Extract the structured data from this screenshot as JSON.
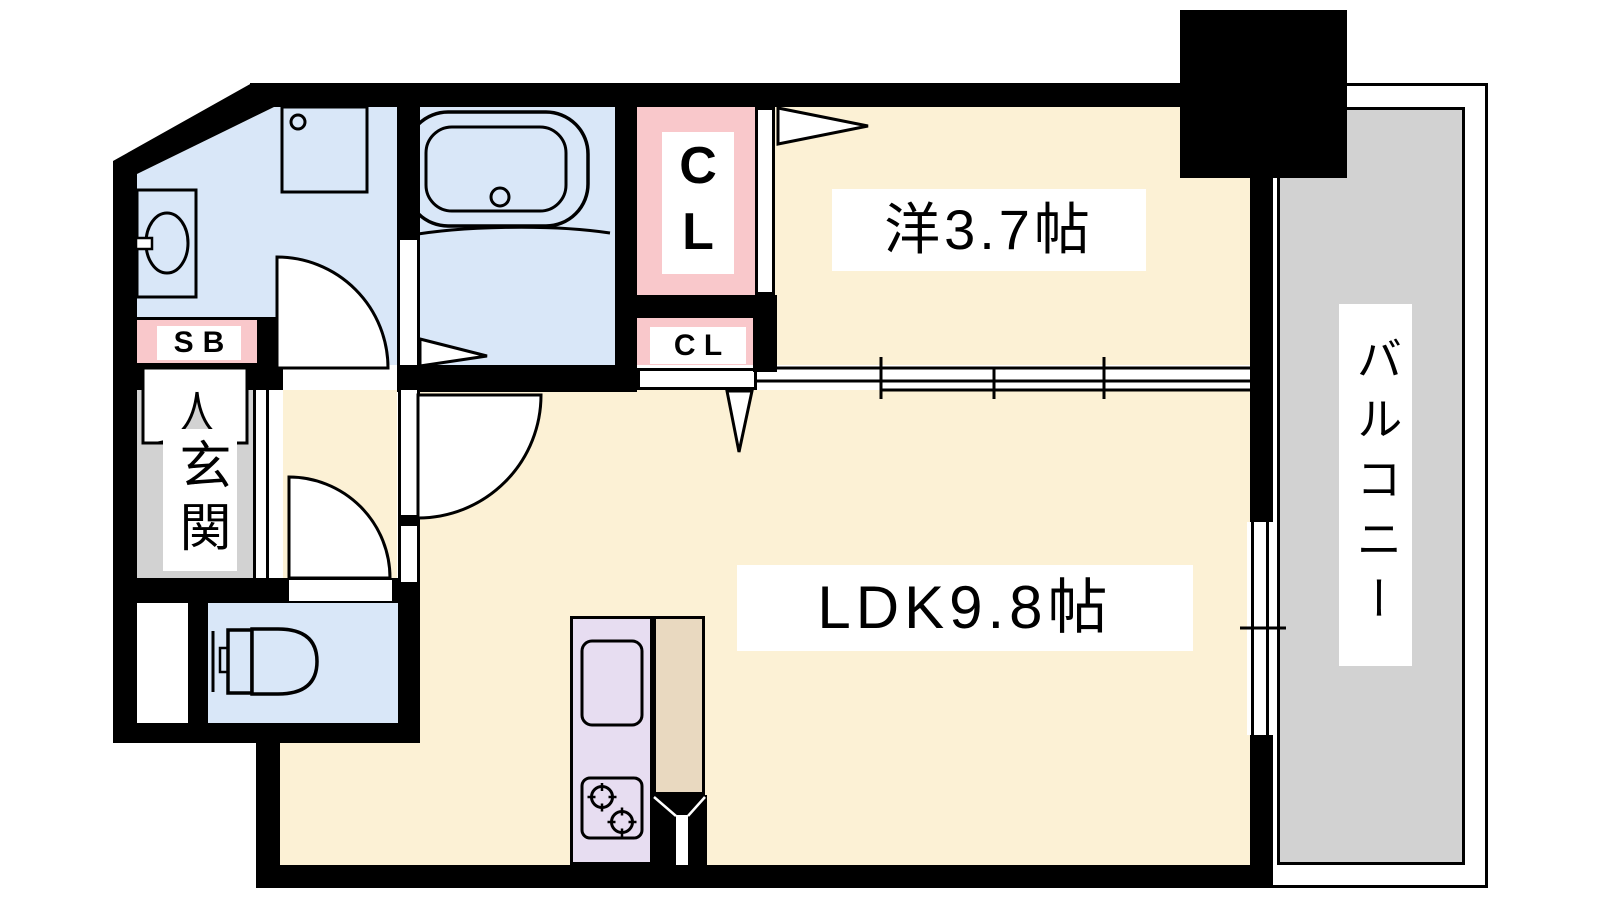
{
  "floor_plan": {
    "rooms": {
      "entrance": {
        "label": "玄関"
      },
      "shoe_box": {
        "label": "SB"
      },
      "closet_upper": {
        "label": "CL"
      },
      "closet_lower": {
        "label": "C L"
      },
      "western_room": {
        "label": "洋3.7帖",
        "size_jo": 3.7
      },
      "ldk": {
        "label": "LDK9.8帖",
        "size_jo": 9.8
      },
      "balcony": {
        "label": "バルコニー"
      }
    },
    "fixtures": [
      "bathtub",
      "washing-machine-pan",
      "washbasin",
      "toilet",
      "kitchen-sink",
      "gas-stove"
    ],
    "colors": {
      "room_cream": "#FCF1D5",
      "wet_area_blue": "#D9E7F8",
      "closet_pink": "#F9C8CB",
      "kitchen_lavender": "#E7DDF1",
      "counter_tan": "#E9D9C0",
      "concrete_gray": "#D2D2D2",
      "wall_black": "#000000",
      "background": "#FFFFFF"
    }
  }
}
